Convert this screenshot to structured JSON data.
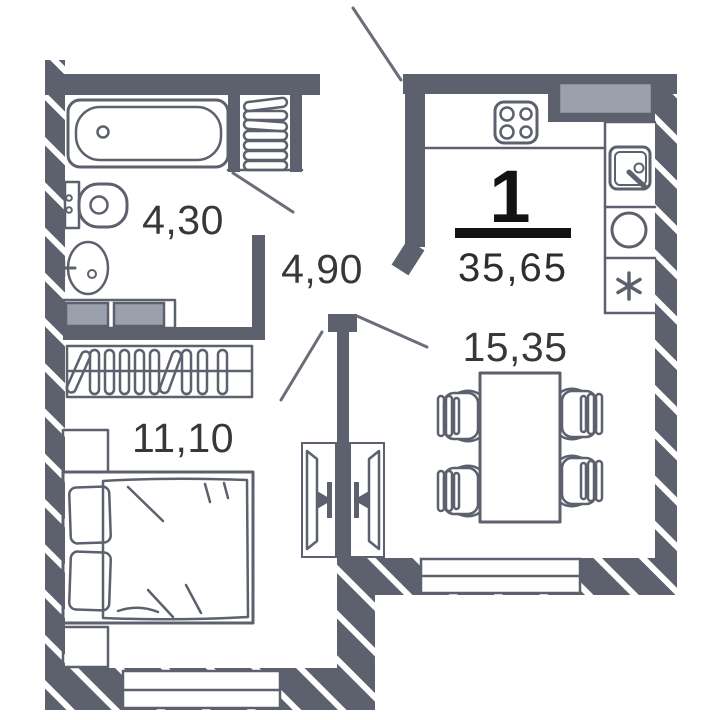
{
  "apartment": {
    "rooms_count": "1",
    "total_area": "35,65"
  },
  "rooms": {
    "bathroom": {
      "area": "4,30"
    },
    "hallway": {
      "area": "4,90"
    },
    "bedroom": {
      "area": "11,10"
    },
    "living_kitchen": {
      "area": "15,35"
    }
  },
  "colors": {
    "wall": "#5c616d",
    "hatch_line": "#ffffff",
    "furniture_fill": "#9ba1ac",
    "outline": "#5c616d",
    "room_label_text": "#38383a",
    "summary_text": "#121212",
    "background": "#ffffff"
  },
  "icons": {
    "fixtures": [
      "bathtub-icon",
      "toilet-icon",
      "washbasin-icon",
      "towel-radiator-icon",
      "laundry-boxes-icon",
      "wardrobe-icon",
      "bed-icon",
      "nightstand-icon",
      "tv-icon",
      "dining-table-icon",
      "chair-icon",
      "stove-icon",
      "kitchen-sink-icon",
      "washing-machine-icon",
      "fridge-icon",
      "window-icon",
      "door-swing-icon",
      "kitchen-cabinet-icon"
    ]
  }
}
